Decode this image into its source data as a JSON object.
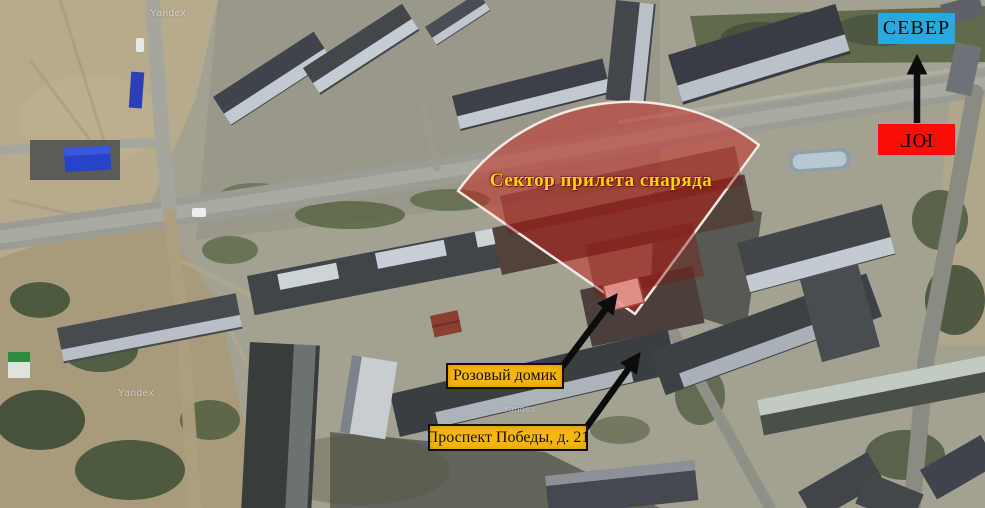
{
  "map": {
    "watermark": "Yandex",
    "sector_label": "Сектор прилета снаряда",
    "labels": {
      "pink_house": "Розовый домик",
      "address": "Проспект Победы, д. 21"
    },
    "compass": {
      "north": "СЕВЕР",
      "south": "ЮГ"
    },
    "colors": {
      "sector_fill": "#c8201a",
      "sector_stroke": "#f5e8e2",
      "sector_text": "#ffd400",
      "label_bg": "#f7b60c",
      "north_bg": "#29a9e0",
      "south_bg": "#fb0d07"
    }
  }
}
